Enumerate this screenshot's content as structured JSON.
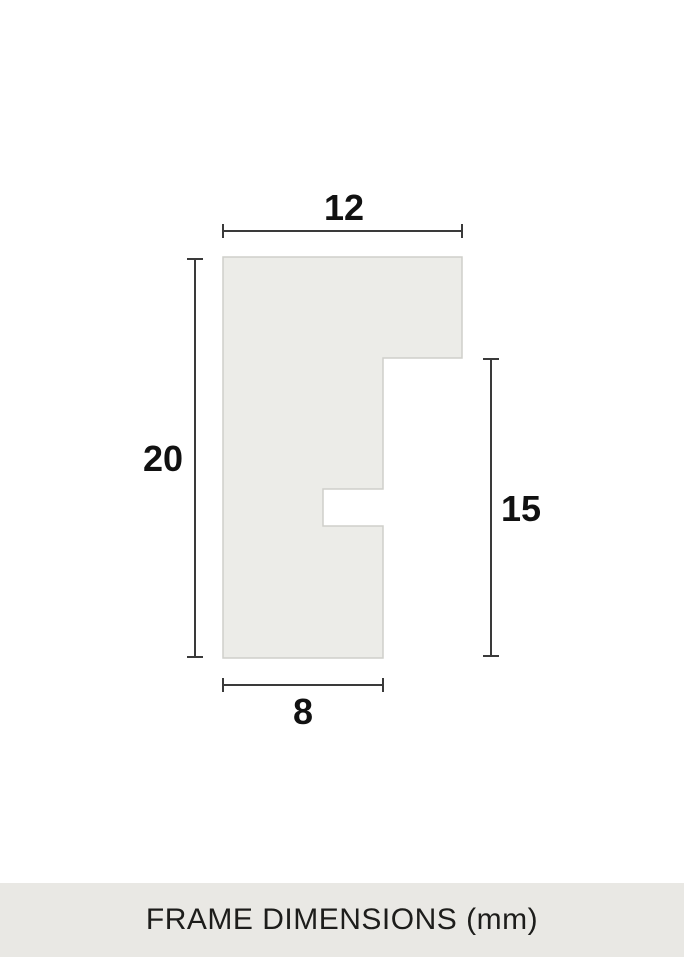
{
  "diagram": {
    "type": "frame-profile-cross-section",
    "unit": "mm",
    "labels": {
      "top_width": "12",
      "left_height": "20",
      "right_height": "15",
      "bottom_width": "8"
    },
    "profile_measurements_mm": {
      "overall_width": 12,
      "overall_height": 20,
      "rabbet_side_height": 15,
      "base_width": 8
    }
  },
  "footer": {
    "title": "FRAME DIMENSIONS (mm)"
  },
  "colors": {
    "page_background": "#FFFFFF",
    "shape_fill": "#ECECE8",
    "shape_border": "#CFCFCA",
    "dimension_line": "#3A3A3A",
    "label_text": "#111111",
    "footer_background": "#E9E8E4",
    "footer_text": "#1D1D1B"
  }
}
